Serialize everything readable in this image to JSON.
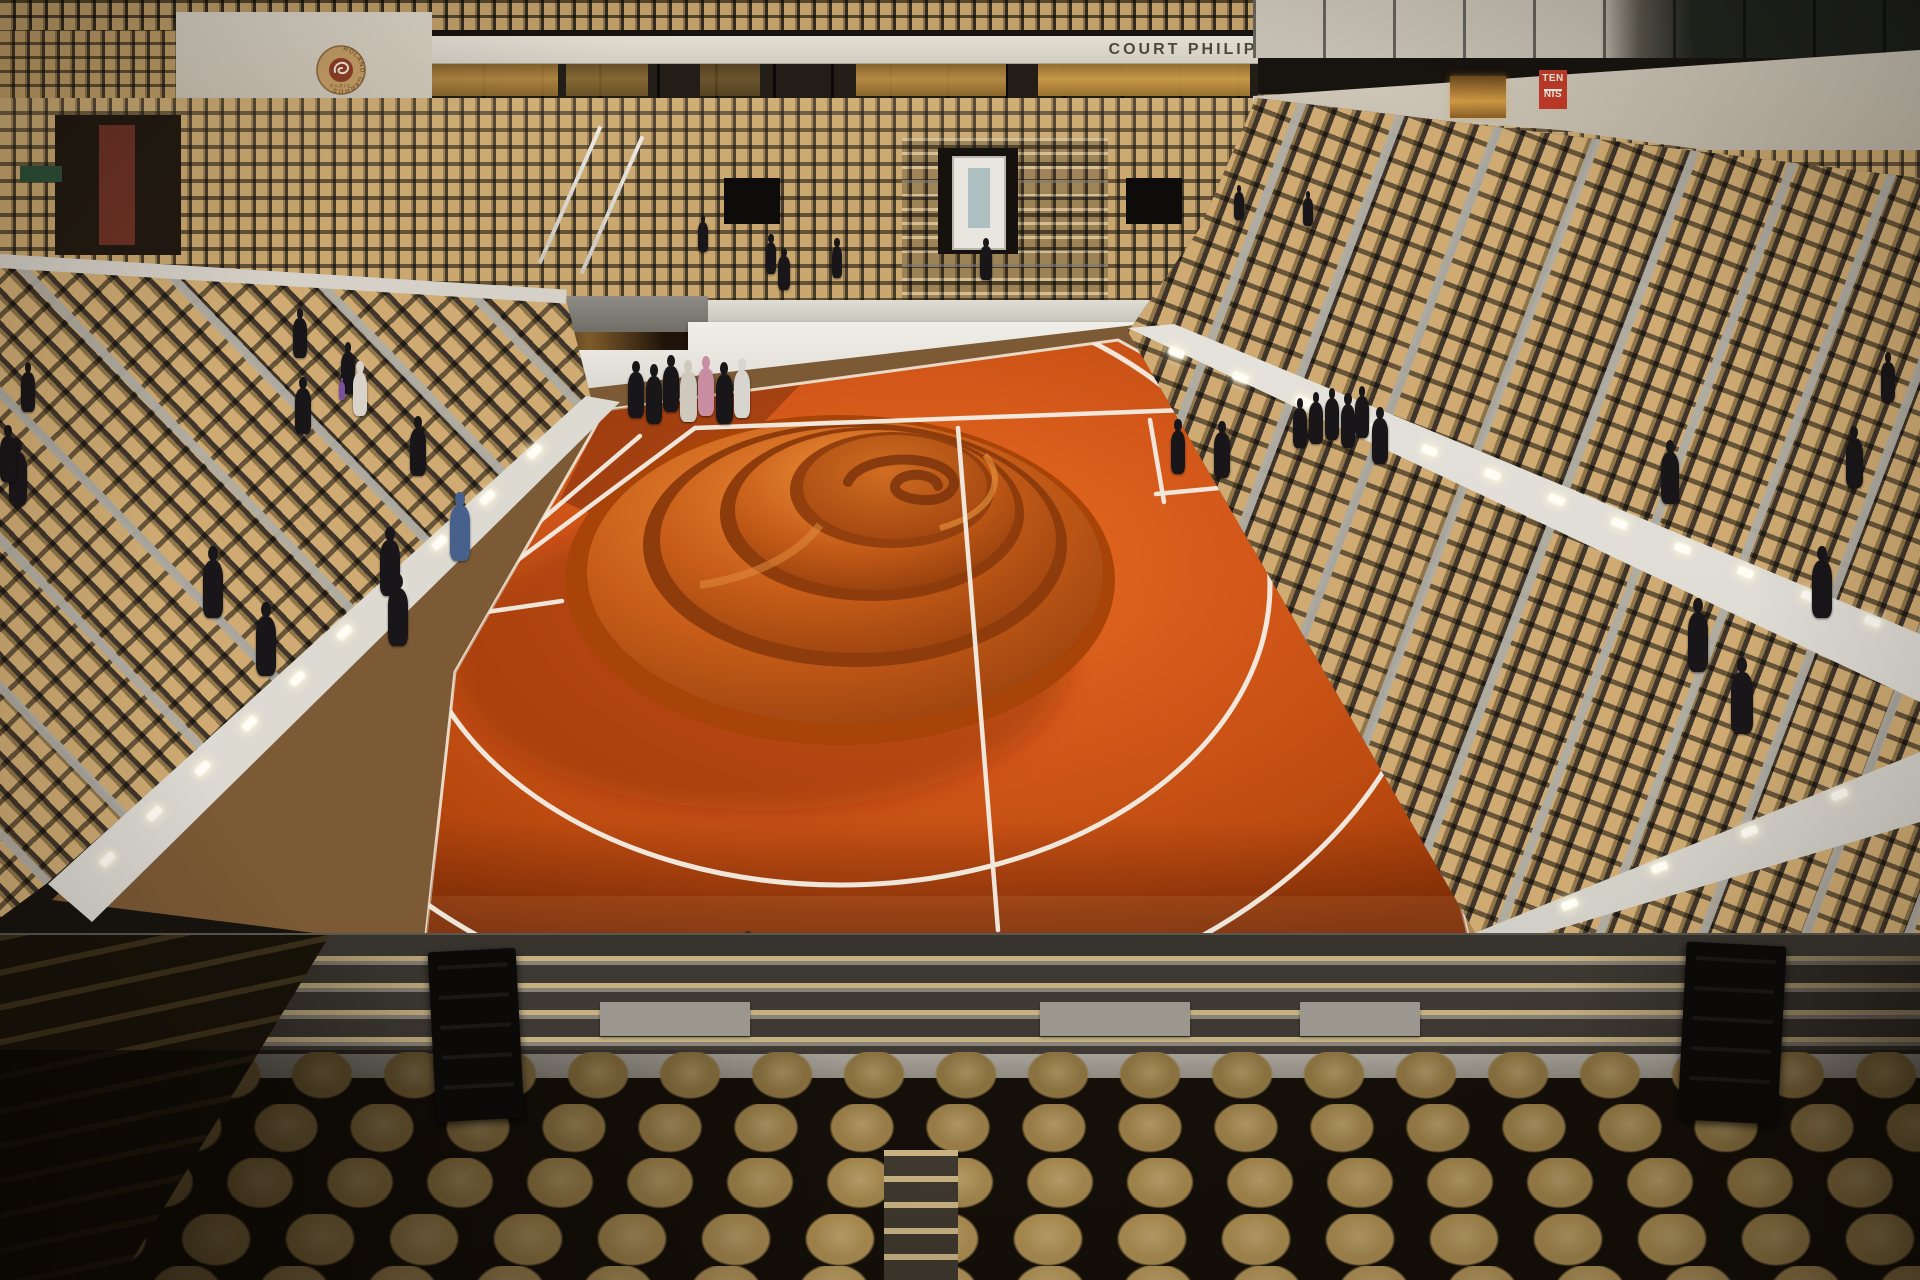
{
  "signage": {
    "banner_text": "COURT PHILIPPE - CHATRIER",
    "tennis_sign": {
      "line1": "TEN",
      "line2": "NIS"
    },
    "logo": {
      "ring_text": "ROLAND GARROS",
      "city": "PARIS"
    }
  },
  "colors": {
    "clay": "#d4581a",
    "clay_bright": "#e8701f",
    "clay_dark": "#a03c09",
    "line_white": "#f4efe5",
    "seat_tan": "#c9a76e",
    "foreground_seat": "#a78b52",
    "wall_cream": "#d6d0c4",
    "wall_white": "#eceae4",
    "divider_gray": "#a8a59d",
    "sign_red": "#c23b2a",
    "wood_walkway": "#b28a55"
  },
  "scene": {
    "suite_windows": [
      {
        "x": 432,
        "w": 126,
        "b": 0.75
      },
      {
        "x": 566,
        "w": 82,
        "b": 0.55
      },
      {
        "x": 700,
        "w": 60,
        "b": 0.4
      },
      {
        "x": 856,
        "w": 150,
        "b": 0.8
      },
      {
        "x": 1038,
        "w": 212,
        "b": 0.9
      }
    ],
    "lights": {
      "left_wall": {
        "angle": -44,
        "points": [
          [
            535,
            452
          ],
          [
            488,
            498
          ],
          [
            440,
            543
          ],
          [
            393,
            588
          ],
          [
            345,
            633
          ],
          [
            298,
            679
          ],
          [
            250,
            724
          ],
          [
            203,
            769
          ],
          [
            155,
            814
          ],
          [
            108,
            860
          ]
        ]
      },
      "right_wall": {
        "angle": 21,
        "points": [
          [
            1177,
            353
          ],
          [
            1241,
            378
          ],
          [
            1304,
            402
          ],
          [
            1367,
            427
          ],
          [
            1430,
            451
          ],
          [
            1493,
            475
          ],
          [
            1557,
            500
          ],
          [
            1620,
            524
          ],
          [
            1683,
            549
          ],
          [
            1746,
            573
          ],
          [
            1810,
            597
          ],
          [
            1873,
            622
          ]
        ]
      },
      "bottom_right_wall": {
        "angle": -21,
        "points": [
          [
            1570,
            905
          ],
          [
            1660,
            868
          ],
          [
            1750,
            832
          ],
          [
            1840,
            795
          ]
        ]
      },
      "bottom_left_wall": {
        "angle": -23,
        "points": [
          [
            380,
            960
          ],
          [
            300,
            1000
          ],
          [
            218,
            1042
          ]
        ]
      }
    },
    "people": {
      "court": [
        {
          "x": 1178,
          "y": 430,
          "h": 44
        },
        {
          "x": 1222,
          "y": 432,
          "h": 46
        },
        {
          "x": 1300,
          "y": 408,
          "h": 40
        },
        {
          "x": 1316,
          "y": 402,
          "h": 42
        },
        {
          "x": 1332,
          "y": 398,
          "h": 42
        },
        {
          "x": 1348,
          "y": 404,
          "h": 44
        },
        {
          "x": 1362,
          "y": 396,
          "h": 42
        },
        {
          "x": 1380,
          "y": 418,
          "h": 46
        }
      ],
      "corner_group": [
        {
          "x": 636,
          "y": 372,
          "h": 46
        },
        {
          "x": 654,
          "y": 376,
          "h": 48
        },
        {
          "x": 671,
          "y": 366,
          "h": 46
        },
        {
          "x": 688,
          "y": 372,
          "h": 50,
          "c": "#cfc8bc"
        },
        {
          "x": 706,
          "y": 368,
          "h": 48,
          "c": "#c98da1"
        },
        {
          "x": 724,
          "y": 374,
          "h": 50
        },
        {
          "x": 742,
          "y": 370,
          "h": 48,
          "c": "#d8d5cf"
        }
      ],
      "left_stands": [
        {
          "x": 18,
          "y": 452,
          "h": 54
        },
        {
          "x": 213,
          "y": 560,
          "h": 58
        },
        {
          "x": 303,
          "y": 388,
          "h": 46
        },
        {
          "x": 348,
          "y": 352,
          "h": 42
        },
        {
          "x": 360,
          "y": 372,
          "h": 44,
          "c": "#d8d2c8"
        },
        {
          "x": 390,
          "y": 540,
          "h": 56
        },
        {
          "x": 418,
          "y": 428,
          "h": 48
        },
        {
          "x": 300,
          "y": 318,
          "h": 40
        },
        {
          "x": 460,
          "y": 505,
          "h": 56,
          "c": "#47618c"
        },
        {
          "x": 398,
          "y": 588,
          "h": 58
        },
        {
          "x": 266,
          "y": 616,
          "h": 60
        },
        {
          "x": 342,
          "y": 382,
          "h": 18,
          "c": "#7a4f9e"
        }
      ],
      "right_stands": [
        {
          "x": 1670,
          "y": 452,
          "h": 52
        },
        {
          "x": 1854,
          "y": 438,
          "h": 50
        },
        {
          "x": 1698,
          "y": 612,
          "h": 60
        },
        {
          "x": 1742,
          "y": 672,
          "h": 62
        },
        {
          "x": 1822,
          "y": 560,
          "h": 58
        },
        {
          "x": 1888,
          "y": 362,
          "h": 40
        }
      ],
      "far_stands": [
        {
          "x": 703,
          "y": 222,
          "h": 30
        },
        {
          "x": 771,
          "y": 242,
          "h": 32
        },
        {
          "x": 784,
          "y": 256,
          "h": 34
        },
        {
          "x": 837,
          "y": 246,
          "h": 32
        },
        {
          "x": 986,
          "y": 246,
          "h": 34
        },
        {
          "x": 1239,
          "y": 192,
          "h": 28
        },
        {
          "x": 1308,
          "y": 198,
          "h": 28
        },
        {
          "x": 28,
          "y": 372,
          "h": 40
        },
        {
          "x": 8,
          "y": 436,
          "h": 46
        }
      ],
      "bottom": [
        {
          "x": 748,
          "y": 950,
          "h": 78,
          "c": "#3a2c20"
        },
        {
          "x": 1188,
          "y": 952,
          "h": 60
        }
      ]
    },
    "foreground_rows": [
      {
        "top": 1052,
        "h": 56,
        "size": 92,
        "c": "#8a7140",
        "off": 0
      },
      {
        "top": 1104,
        "h": 58,
        "size": 96,
        "c": "#977c47",
        "off": 46
      },
      {
        "top": 1158,
        "h": 60,
        "size": 100,
        "c": "#a3864d",
        "off": 10
      },
      {
        "top": 1214,
        "h": 62,
        "size": 104,
        "c": "#ad8f53",
        "off": 60
      },
      {
        "top": 1266,
        "h": 66,
        "size": 108,
        "c": "#b5965a",
        "off": 24
      }
    ]
  }
}
